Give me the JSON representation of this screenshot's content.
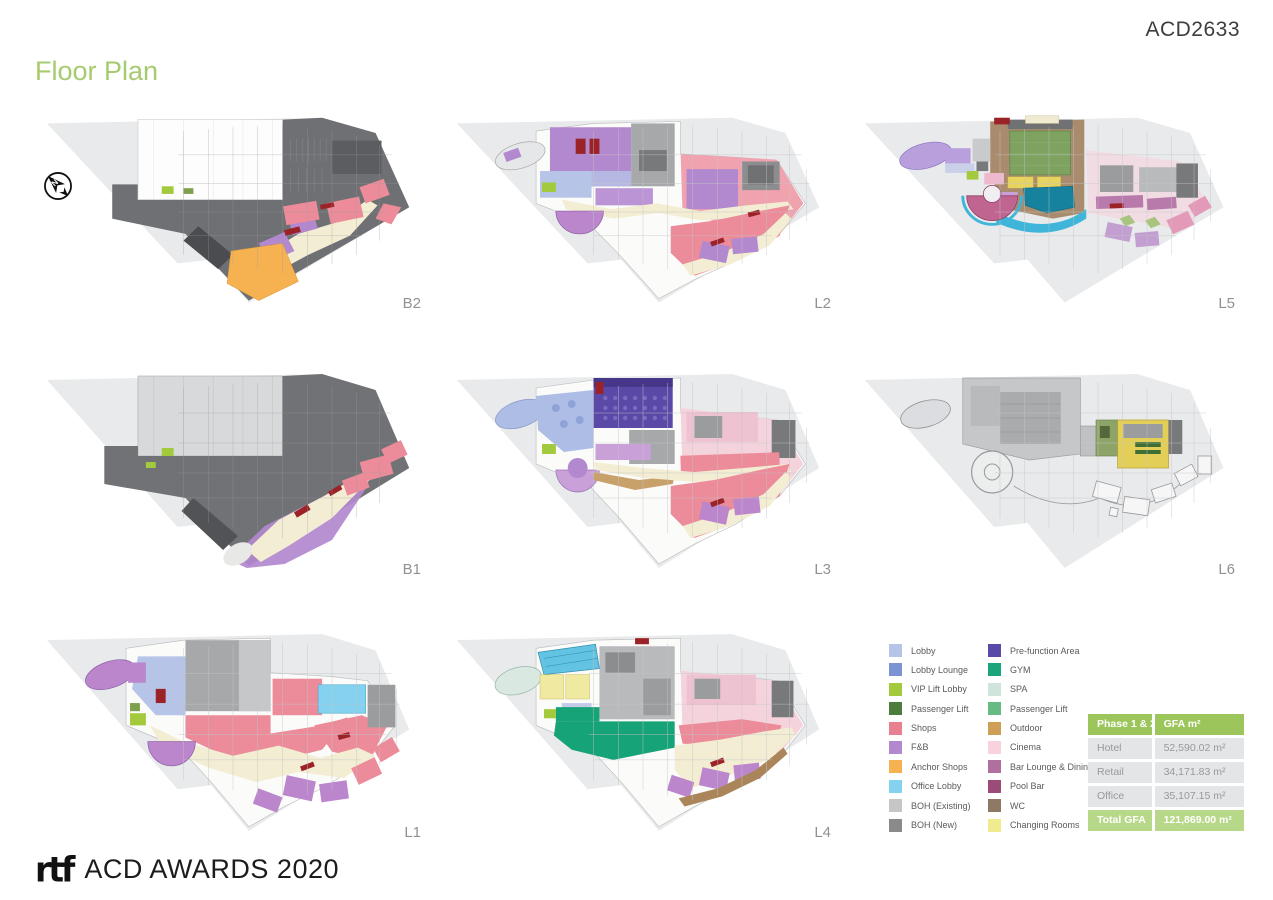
{
  "header": {
    "project_code": "ACD2633",
    "title": "Floor Plan",
    "title_color": "#a6cb6e"
  },
  "north_arrow": {
    "label": "N"
  },
  "floors": [
    {
      "id": "b2",
      "label": "B2"
    },
    {
      "id": "l2",
      "label": "L2"
    },
    {
      "id": "l5",
      "label": "L5"
    },
    {
      "id": "b1",
      "label": "B1"
    },
    {
      "id": "l3",
      "label": "L3"
    },
    {
      "id": "l6",
      "label": "L6"
    },
    {
      "id": "l1",
      "label": "L1"
    },
    {
      "id": "l4",
      "label": "L4"
    }
  ],
  "legend": {
    "columns": [
      [
        {
          "label": "Lobby",
          "color": "#b6c4e8"
        },
        {
          "label": "Lobby Lounge",
          "color": "#7b93d1"
        },
        {
          "label": "VIP Lift Lobby",
          "color": "#a3c93c"
        },
        {
          "label": "Passenger Lift",
          "color": "#4c7d3c"
        },
        {
          "label": "Shops",
          "color": "#e8808f"
        },
        {
          "label": "F&B",
          "color": "#b288cf"
        },
        {
          "label": "Anchor Shops",
          "color": "#f6b151"
        },
        {
          "label": "Office Lobby",
          "color": "#84d2ef"
        },
        {
          "label": "BOH (Existing)",
          "color": "#c6c6c6"
        },
        {
          "label": "BOH (New)",
          "color": "#8a8a8a"
        }
      ],
      [
        {
          "label": "Pre-function Area",
          "color": "#5b49a8"
        },
        {
          "label": "GYM",
          "color": "#1ca57c"
        },
        {
          "label": "SPA",
          "color": "#cfe4da"
        },
        {
          "label": "Passenger Lift",
          "color": "#66bb84"
        },
        {
          "label": "Outdoor",
          "color": "#cf9f58"
        },
        {
          "label": "Cinema",
          "color": "#f8d2dc"
        },
        {
          "label": "Bar Lounge & Dining",
          "color": "#b16f9f"
        },
        {
          "label": "Pool Bar",
          "color": "#9c4a78"
        },
        {
          "label": "WC",
          "color": "#8e7a64"
        },
        {
          "label": "Changing Rooms",
          "color": "#f1eb90"
        }
      ]
    ]
  },
  "gfa_table": {
    "header": [
      "Phase 1 & 2",
      "GFA m²"
    ],
    "rows": [
      [
        "Hotel",
        "52,590.02 m²"
      ],
      [
        "Retail",
        "34,171.83 m²"
      ],
      [
        "Office",
        "35,107.15 m²"
      ]
    ],
    "total": [
      "Total GFA",
      "121,869.00 m²"
    ],
    "header_bg": "#9cc65c",
    "total_bg": "#b7d888",
    "row_bg": "#e4e5e6"
  },
  "footer": {
    "logo": "rtf",
    "text": "ACD AWARDS 2020"
  }
}
